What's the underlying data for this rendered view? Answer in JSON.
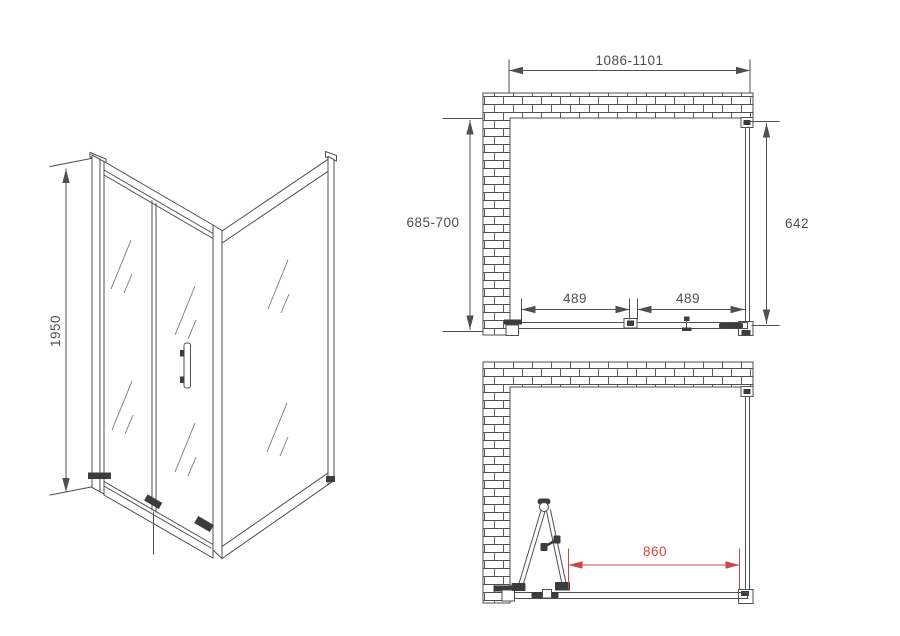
{
  "drawing": {
    "type": "shower-enclosure-installation-dimensions",
    "colors": {
      "line": "#4f4f4f",
      "dimension_red": "#cf4545",
      "background": "#ffffff"
    },
    "perspective_view": {
      "height_mm": "1950"
    },
    "plan_closed": {
      "width_range_mm": "1086-1101",
      "depth_range_mm": "685-700",
      "side_panel_mm": "642",
      "left_section_mm": "489",
      "right_section_mm": "489"
    },
    "plan_open": {
      "opening_mm": "860"
    }
  }
}
